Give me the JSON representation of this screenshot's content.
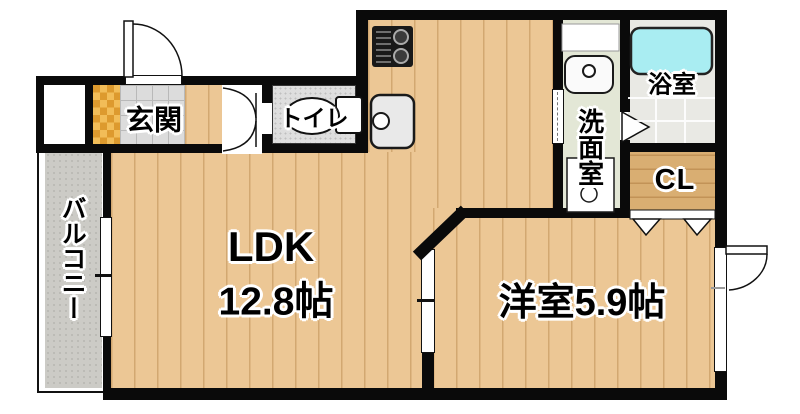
{
  "plan": {
    "type": "apartment-floor-plan",
    "labels": {
      "ldk_name": "LDK",
      "ldk_size": "12.8帖",
      "western_room": "洋室5.9帖",
      "entrance": "玄関",
      "toilet": "トイレ",
      "bath": "浴室",
      "washroom": "洗面室",
      "closet": "CL",
      "balcony": "バルコニー"
    },
    "colors": {
      "wall": "#0a0a0a",
      "wood_floor": "#ecc795",
      "closet_floor": "#d9ae72",
      "balcony_floor": "#cccbc6",
      "bathtub": "#a9edf2",
      "bath_tile": "#e9e9e4",
      "washroom_floor": "#e3e7d6",
      "tile_gray": "#dcdcdc",
      "entrance_mat": "#e8a53c"
    }
  }
}
